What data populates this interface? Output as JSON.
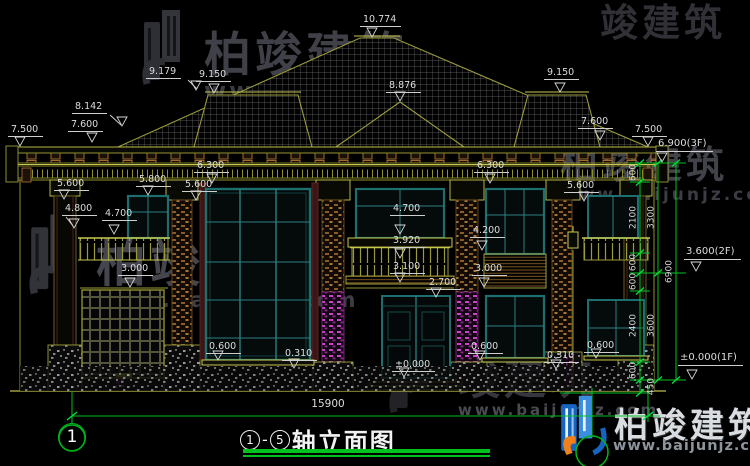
{
  "drawing": {
    "title_text": "轴立面图",
    "axis_start": "1",
    "axis_end": "5",
    "axis_dash": "-",
    "axis_grid_bubble": "1"
  },
  "elev": {
    "e10774": "10.774",
    "e9179": "9.179",
    "e9150": "9.150",
    "e8876": "8.876",
    "e8142": "8.142",
    "e7600": "7.600",
    "e7500": "7.500",
    "e6900f": "6.900(3F)",
    "e6300": "6.300",
    "e5800": "5.800",
    "e5600": "5.600",
    "e4800": "4.800",
    "e4700": "4.700",
    "e4200": "4.200",
    "e3920": "3.920",
    "e3600f": "3.600(2F)",
    "e3100": "3.100",
    "e3000": "3.000",
    "e2700": "2.700",
    "e0600": "0.600",
    "e0310": "0.310",
    "e0000": "±0.000",
    "e0000f": "±0.000(1F)"
  },
  "dims": {
    "v600": "600",
    "v2100": "2100",
    "v2400": "2400",
    "v450": "450",
    "v3300": "3300",
    "v3600": "3600",
    "v6900": "6900",
    "total_width": "15900"
  },
  "watermark": {
    "brand": "柏竣建筑",
    "brand_short": "竣建筑",
    "url": "www.baijunjz.com"
  },
  "colors": {
    "background": "#000000",
    "cad_line": "#9c9c3c",
    "cad_bright": "#c8c84f",
    "dimension_green": "#00c322",
    "window_teal": "#1d6e6e",
    "detail_brown": "#a06a30",
    "accent_magenta": "#cc44cc",
    "logo_blue": "#1565c0",
    "logo_orange": "#f08018",
    "title_underline": "#00c21e"
  }
}
